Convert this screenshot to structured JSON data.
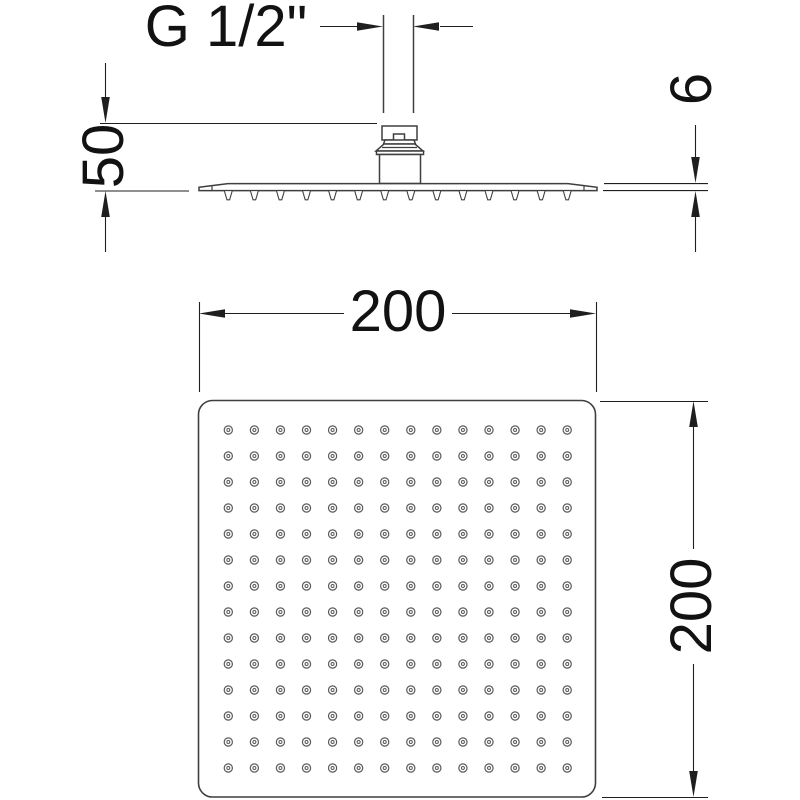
{
  "drawing": {
    "side_view": {
      "thread_label": "G 1/2\"",
      "drop_dimension": "50",
      "plate_thickness_dimension": "6",
      "nozzle_count": 14
    },
    "plan_view": {
      "width_dimension": "200",
      "height_dimension": "200",
      "nozzle_grid": {
        "rows": 14,
        "cols": 14
      }
    },
    "colors": {
      "geometry_line": "#3f3f3f",
      "dimension_line": "#1f1f1f",
      "text": "#121212",
      "background": "#ffffff"
    }
  }
}
